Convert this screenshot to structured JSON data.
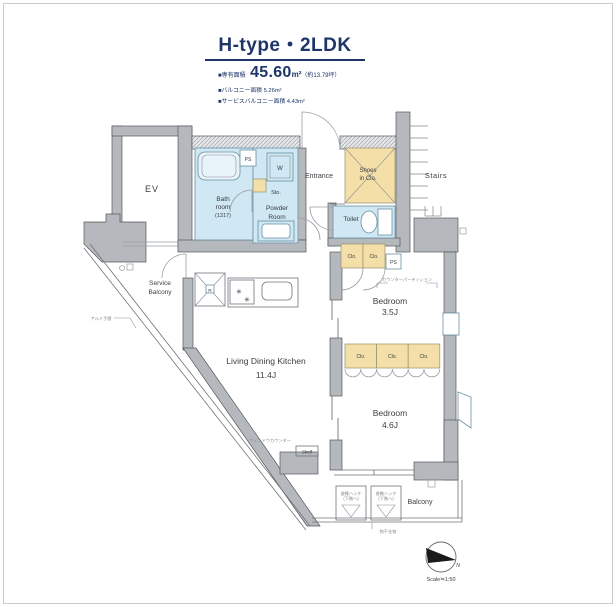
{
  "header": {
    "title": "H-type・2LDK",
    "area_prefix": "■専有面積",
    "area_value": "45.60",
    "area_unit": "m²",
    "area_note": "（約13.79坪）",
    "balcony_area": "■バルコニー面積 5.26m²",
    "service_balcony_area": "■サービスバルコニー面積 4.43m²"
  },
  "rooms": {
    "ev": "EV",
    "bath": [
      "Bath",
      "room",
      "(1317)"
    ],
    "powder": [
      "Powder",
      "Room"
    ],
    "sto": "Sto.",
    "washer": "W",
    "ps": "PS",
    "entrance": "Entrance",
    "shoes": [
      "Shoes",
      "in Clo."
    ],
    "stairs": "Stairs",
    "toilet": "Toilet",
    "clo": "Clo.",
    "bedroom_a": [
      "Bedroom",
      "3.5J"
    ],
    "bedroom_b": [
      "Bedroom",
      "4.6J"
    ],
    "ldk": [
      "Living Dining Kitchen",
      "11.4J"
    ],
    "service_balcony": [
      "Service",
      "Balcony"
    ],
    "balcony": "Balcony",
    "shelf": "Shelf",
    "fridge": "R"
  },
  "annotations": {
    "counter_partition": "カウンターパーティション",
    "window_counter": "ウィンドウカウンター",
    "handrail": "アルミ手摺",
    "laundry_fitting": "物干金物",
    "hatch": [
      "避難ハッチ",
      "(下階へ)"
    ],
    "north": "N",
    "scale": "Scale≒1:50"
  },
  "colors": {
    "navy": "#1d3568",
    "wall_gray": "#b5b9bd",
    "wet_room_blue": "#cfe8f3",
    "closet_tan": "#f4dfa8"
  }
}
